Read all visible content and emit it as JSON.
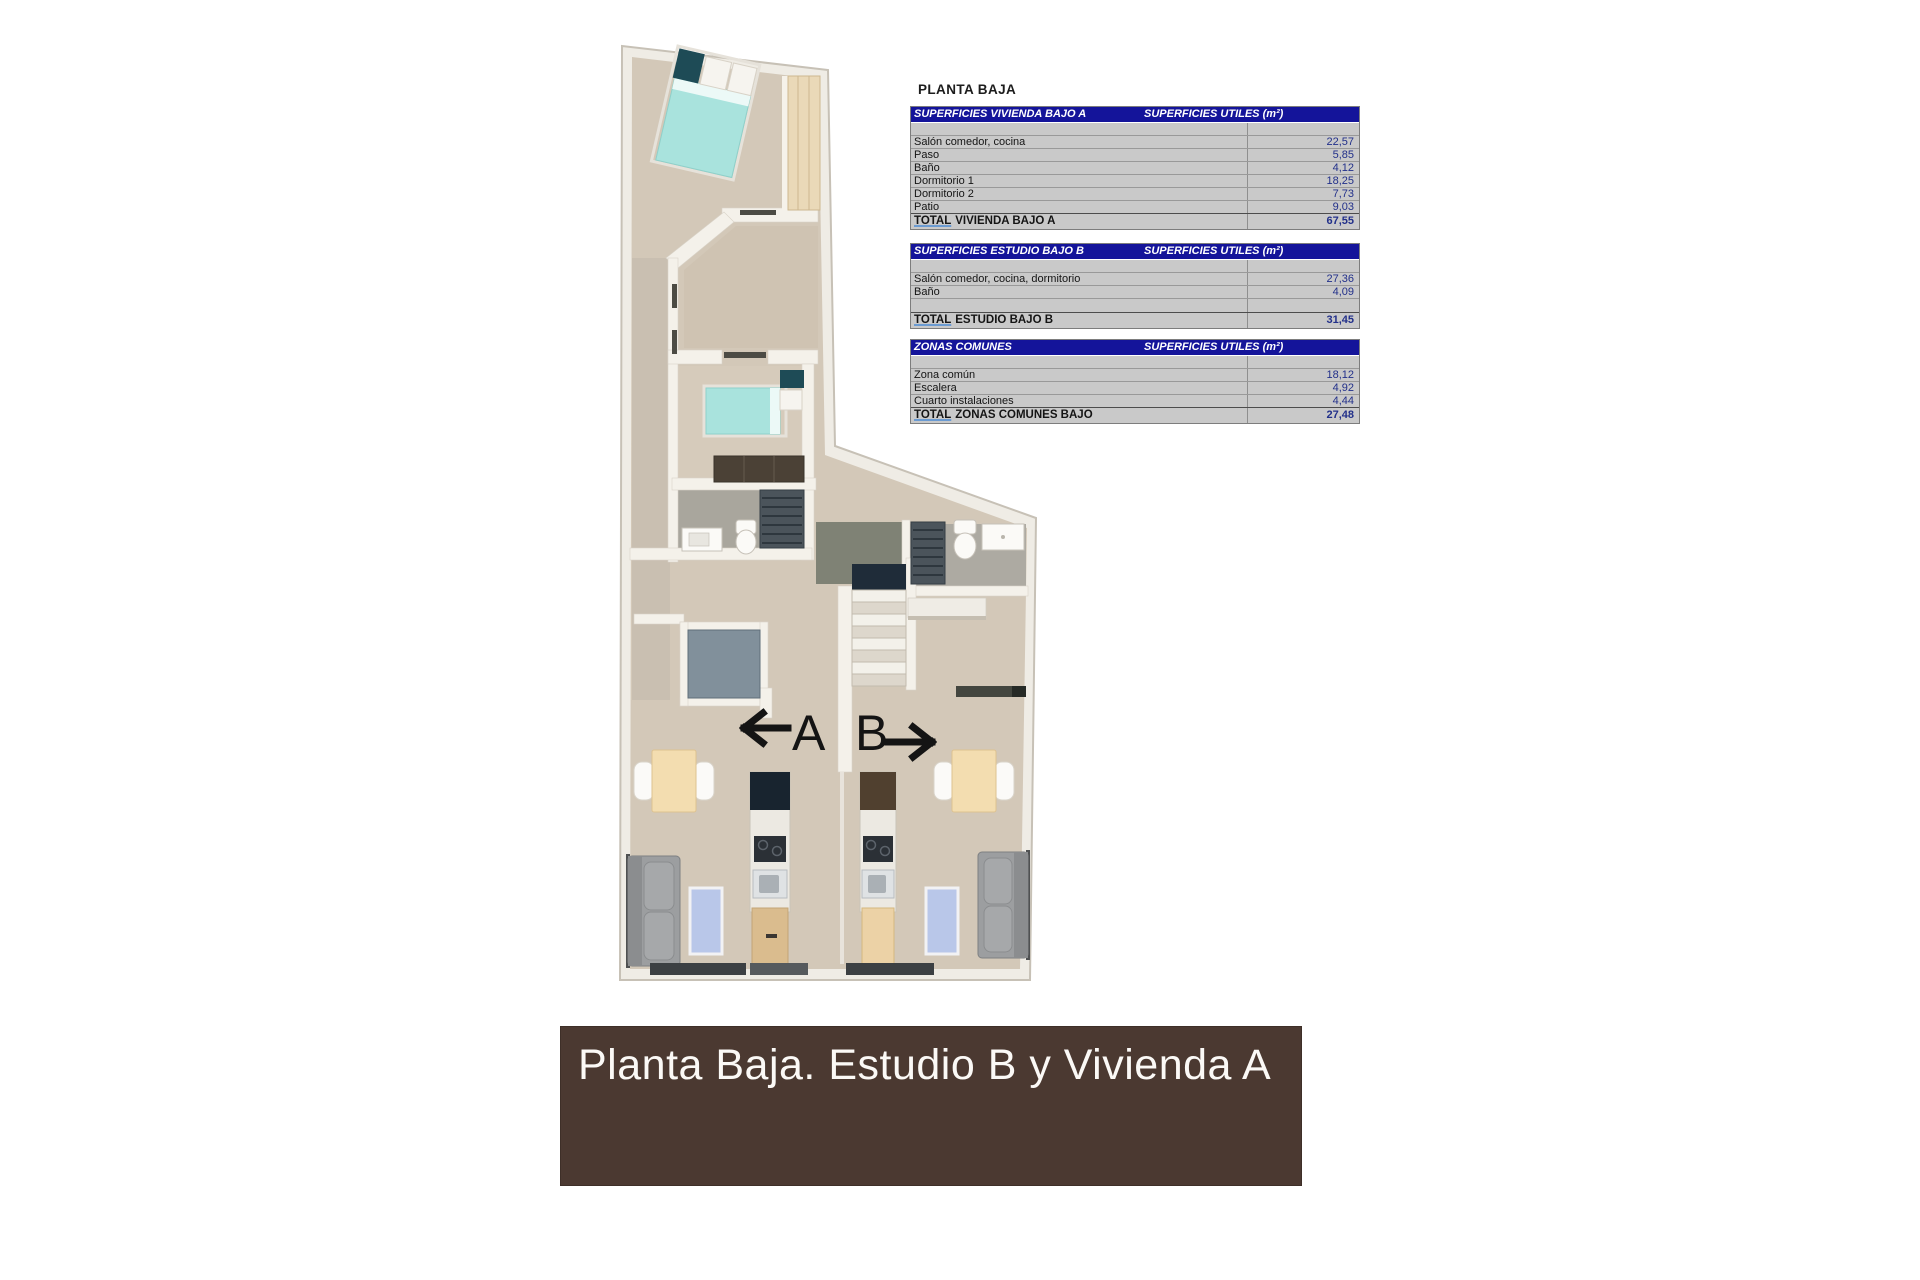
{
  "page_title": "PLANTA BAJA",
  "plan": {
    "unit_a_label": "A",
    "unit_b_label": "B"
  },
  "tables": [
    {
      "title": "SUPERFICIES VIVIENDA BAJO A",
      "units_header": "SUPERFICIES UTILES  (m²)",
      "rows": [
        {
          "label": "Salón comedor, cocina",
          "value": "22,57"
        },
        {
          "label": "Paso",
          "value": "5,85"
        },
        {
          "label": "Baño",
          "value": "4,12"
        },
        {
          "label": "Dormitorio 1",
          "value": "18,25"
        },
        {
          "label": "Dormitorio 2",
          "value": "7,73"
        },
        {
          "label": "Patio",
          "value": "9,03"
        }
      ],
      "total": {
        "word": "TOTAL",
        "rest": "VIVIENDA BAJO A",
        "value": "67,55"
      }
    },
    {
      "title": "SUPERFICIES ESTUDIO BAJO B",
      "units_header": "SUPERFICIES UTILES  (m²)",
      "rows": [
        {
          "label": "Salón comedor, cocina, dormitorio",
          "value": "27,36"
        },
        {
          "label": "Baño",
          "value": "4,09"
        }
      ],
      "total": {
        "word": "TOTAL",
        "rest": "ESTUDIO BAJO B",
        "value": "31,45"
      }
    },
    {
      "title": "ZONAS COMUNES",
      "units_header": "SUPERFICIES UTILES  (m²)",
      "rows": [
        {
          "label": "Zona común",
          "value": "18,12"
        },
        {
          "label": "Escalera",
          "value": "4,92"
        },
        {
          "label": "Cuarto instalaciones",
          "value": "4,44"
        }
      ],
      "total": {
        "word": "TOTAL",
        "rest": "ZONAS COMUNES BAJO",
        "value": "27,48"
      }
    }
  ],
  "banner": {
    "text": "Planta Baja. Estudio B y Vivienda A"
  },
  "colors": {
    "table_header_bg": "#14149a",
    "table_bg": "#c9c9c9",
    "value_text": "#22308a",
    "banner_bg": "#4b3931",
    "floor_beige": "#d3c8b8",
    "bath_gray": "#a9a69d",
    "patio_gray": "#81909b",
    "bed_teal": "#a9e3dd",
    "rug_blue": "#b9c7e9"
  }
}
